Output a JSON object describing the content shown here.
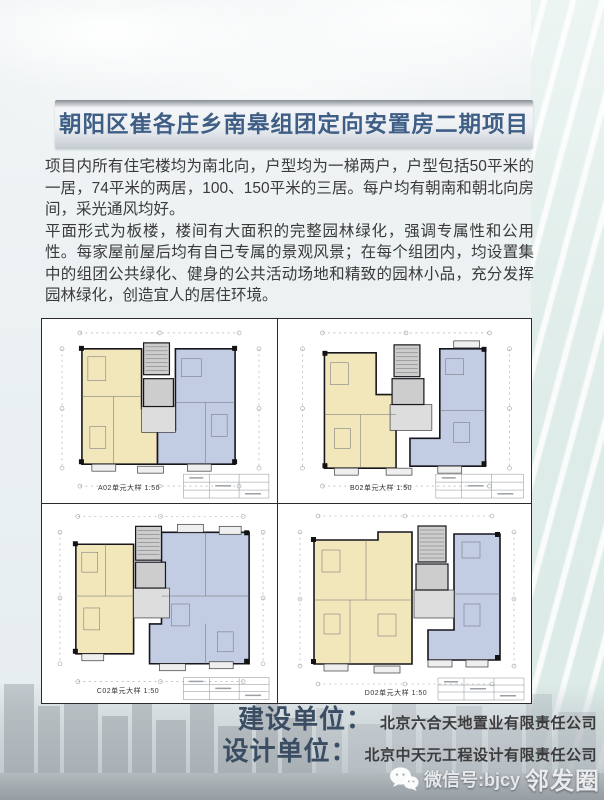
{
  "header": {
    "title": "朝阳区崔各庄乡南皋组团定向安置房二期项目"
  },
  "intro": {
    "paragraph1": "项目内所有住宅楼均为南北向，户型均为一梯两户，户型包括50平米的一居，74平米的两居，100、150平米的三居。每户均有朝南和朝北向房间，采光通风均好。",
    "paragraph2": "平面形式为板楼，楼间有大面积的完整园林绿化，强调专属性和公用性。每家屋前屋后均有自己专属的景观风景；在每个组团内，均设置集中的组团公共绿化、健身的公共活动场地和精致的园林小品，充分发挥园林绿化，创造宜人的居住环境。"
  },
  "floor_plans": {
    "items": [
      {
        "caption": "A02单元大样  1:50"
      },
      {
        "caption": "B02单元大样  1:50"
      },
      {
        "caption": "C02单元大样  1:50"
      },
      {
        "caption": "D02单元大样  1:50"
      }
    ]
  },
  "credits": {
    "builder_label": "建设单位：",
    "builder_name": "北京六合天地置业有限责任公司",
    "designer_label": "设计单位：",
    "designer_name": "北京中天元工程设计有限责任公司"
  },
  "footer": {
    "wechat_prefix": "微信号:bjcy",
    "wechat_suffix": "邻发圈"
  },
  "colors": {
    "unit_yellow": "#f2e6bb",
    "unit_blue": "#c2cce3",
    "core_gray": "#cdcdcd",
    "title_text": "#3f5e86"
  }
}
